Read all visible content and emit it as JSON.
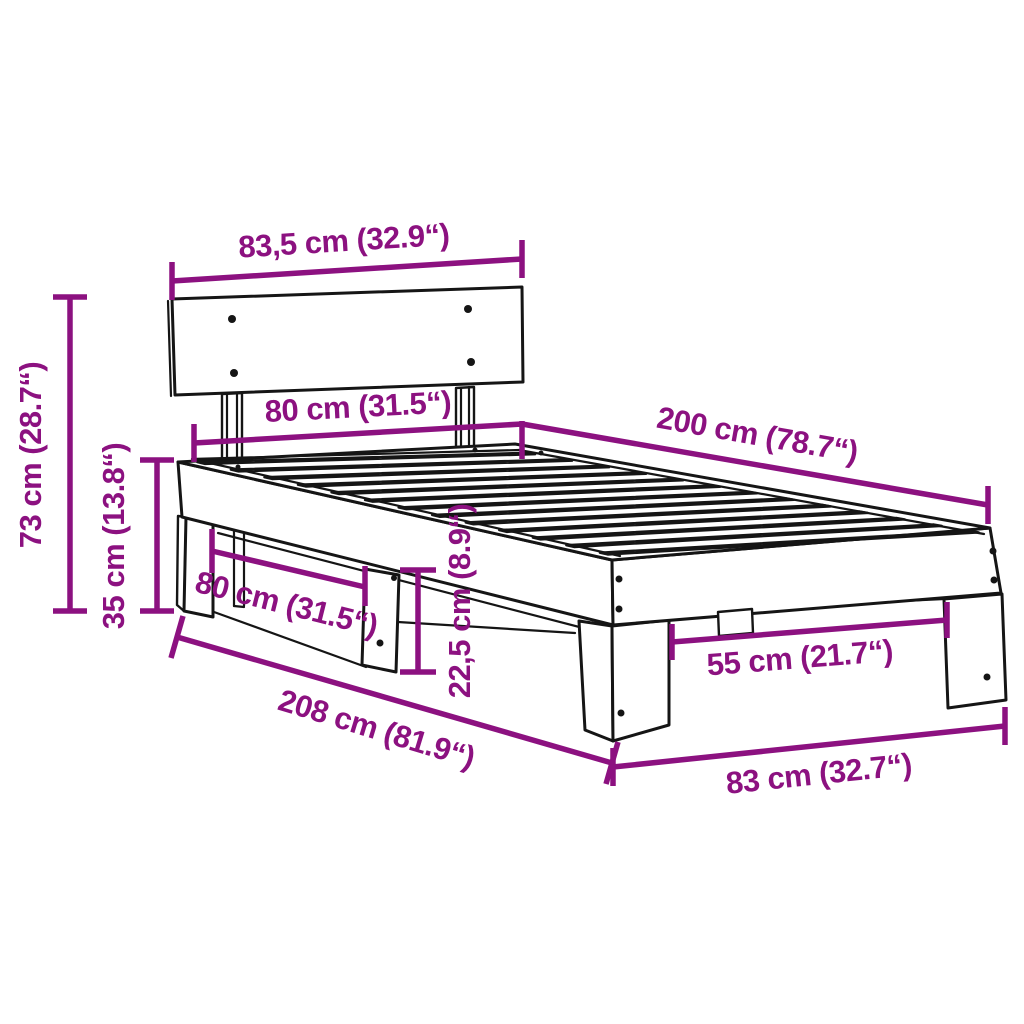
{
  "diagram": {
    "type": "product-dimension-diagram",
    "subject": "bed-frame-with-headboard-and-slats",
    "accent_color": "#8C1180",
    "ink_color": "#151515",
    "background_color": "#ffffff",
    "dimensions": {
      "headboard_width": "83,5 cm (32.9“)",
      "frame_width_top": "80 cm (31.5“)",
      "bed_length": "200 cm (78.7“)",
      "total_height": "73 cm (28.7“)",
      "head_frame_height": "35 cm (13.8“)",
      "leg_span_side": "80 cm (31.5“)",
      "under_bed_clearance": "22,5 cm (8.9“)",
      "total_length": "208 cm (81.9“)",
      "foot_leg_span": "55 cm (21.7“)",
      "foot_width": "83 cm (32.7“)"
    }
  }
}
